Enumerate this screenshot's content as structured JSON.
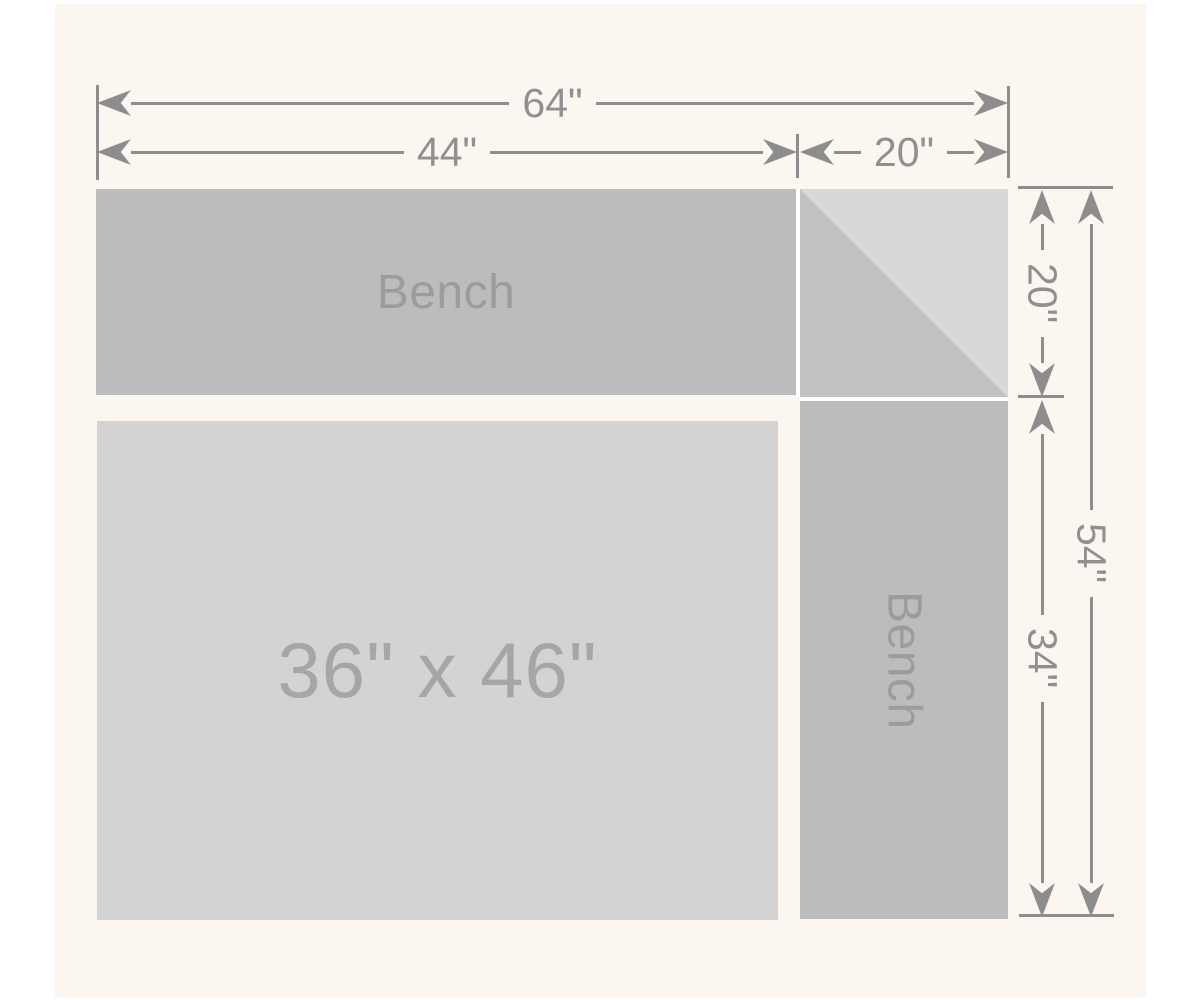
{
  "page": {
    "background": "#ffffff",
    "panel_background": "#fbf6f0"
  },
  "palette": {
    "bench_fill": "#bcbcbc",
    "table_fill": "#d3d3d3",
    "corner_light_fill": "#d8d8d8",
    "corner_dark_fill": "#c1c1c1",
    "dimension_line": "#8d8d8d",
    "dimension_text": "#909090",
    "bench_text": "#9c9c9c",
    "table_text": "#a6a6a6"
  },
  "dimensions": {
    "top": {
      "overall_width": "64\"",
      "bench_section_width": "44\"",
      "corner_section_width": "20\""
    },
    "right": {
      "bench_depth": "20\"",
      "overall_depth": "54\"",
      "lower_section_depth": "34\""
    }
  },
  "shapes": {
    "top_bench": {
      "label": "Bench"
    },
    "right_bench": {
      "label": "Bench"
    },
    "table": {
      "label": "36\" x 46\""
    }
  }
}
